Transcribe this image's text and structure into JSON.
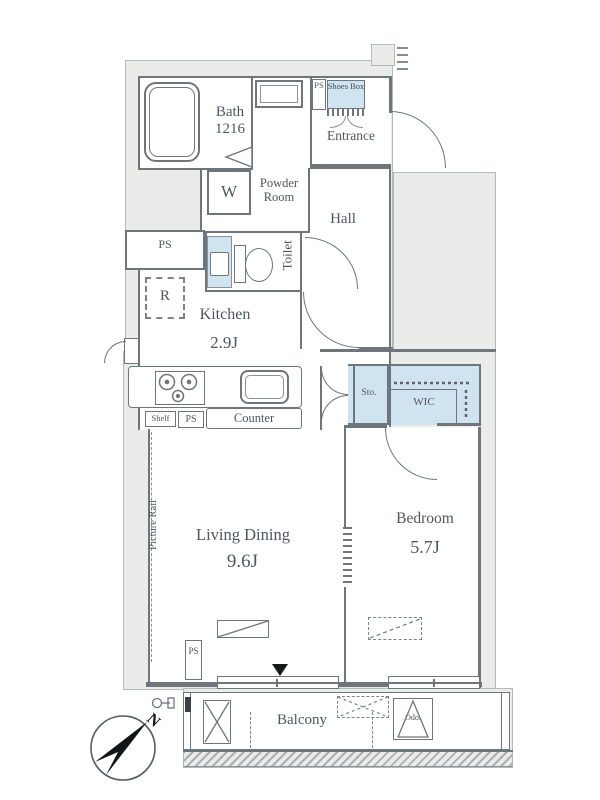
{
  "rooms": {
    "bath": {
      "label": "Bath",
      "size": "1216"
    },
    "powder_room": {
      "label": "Powder Room"
    },
    "entrance": {
      "label": "Entrance"
    },
    "hall": {
      "label": "Hall"
    },
    "toilet": {
      "label": "Toilet"
    },
    "kitchen": {
      "label": "Kitchen",
      "size": "2.9J"
    },
    "living_dining": {
      "label": "Living Dining",
      "size": "9.6J"
    },
    "bedroom": {
      "label": "Bedroom",
      "size": "5.7J"
    },
    "balcony": {
      "label": "Balcony"
    },
    "wic": {
      "label": "WIC"
    },
    "storage": {
      "label": "Sto."
    },
    "shoes_box": {
      "label": "Shoes Box"
    }
  },
  "labels": {
    "ps": "PS",
    "refrigerator": "R",
    "washer": "W",
    "shelf": "Shelf",
    "counter": "Counter",
    "picture_rail": "Picture Rail",
    "outdoor_unit": "Odo.",
    "north": "N"
  },
  "colors": {
    "wall": "#6f767b",
    "area_fill": "#e9ece9",
    "closet_fill": "#cfe4f0",
    "text": "#4d575f"
  }
}
